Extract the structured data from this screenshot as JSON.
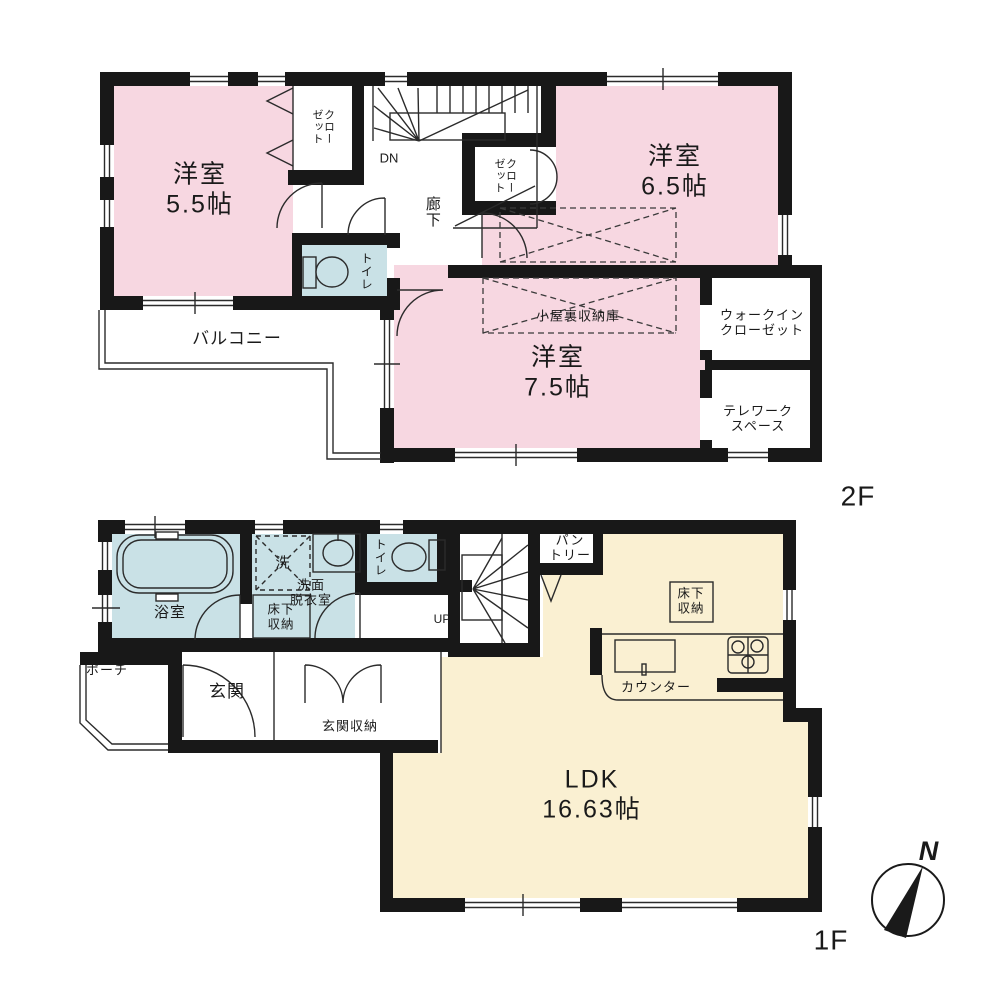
{
  "colors": {
    "room_pink": "#f7d7e1",
    "wet_area_blue": "#c9e1e6",
    "ldk_cream": "#faf0d2",
    "wall_black": "#181818"
  },
  "floor2": {
    "label": "2F",
    "room_5_5": "洋室\n5.5帖",
    "room_6_5": "洋室\n6.5帖",
    "room_7_5": "洋室\n7.5帖",
    "balcony": "バルコニー",
    "hallway": "廊下",
    "closet_a": "クローゼット",
    "closet_b": "クローゼット",
    "toilet": "トイレ",
    "attic_storage": "小屋裏収納庫",
    "walk_in_closet": "ウォークイン\nクローゼット",
    "telework_space": "テレワーク\nスペース",
    "stairs_down": "DN"
  },
  "floor1": {
    "label": "1F",
    "ldk": "LDK\n16.63帖",
    "bath": "浴室",
    "washer": "洗",
    "washroom": "洗面\n脱衣室",
    "underfloor_storage_washroom": "床下\n収納",
    "underfloor_storage_ldk": "床下\n収納",
    "toilet": "トイレ",
    "stairs_up": "UP",
    "pantry": "パン\nトリー",
    "entrance": "玄関",
    "porch": "ポーチ",
    "entrance_storage": "玄関収納",
    "kitchen_counter": "カウンター"
  },
  "compass": {
    "north": "N"
  }
}
